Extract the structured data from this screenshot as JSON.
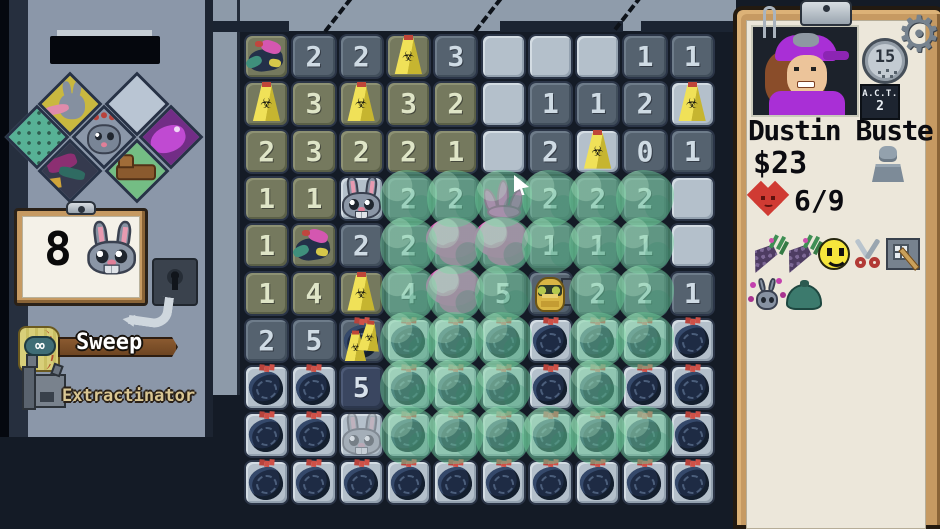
{
  "left_panel": {
    "badges": [
      {
        "id": "badge-yellow-rabbit"
      },
      {
        "id": "badge-empty"
      },
      {
        "id": "badge-teal-pattern"
      },
      {
        "id": "badge-rabbit-face"
      },
      {
        "id": "badge-purple-creature"
      },
      {
        "id": "badge-dark-creature"
      },
      {
        "id": "badge-green-couch"
      }
    ],
    "counter": {
      "value": "8",
      "icon": "rabbit-icon"
    },
    "tools": [
      {
        "id": "sweep",
        "label": "Sweep",
        "badge": "∞",
        "icon": "broom-icon"
      },
      {
        "id": "extractinator",
        "label": "Extractinator",
        "icon": "machine-icon"
      }
    ]
  },
  "character_panel": {
    "name": "Dustin Buste",
    "money": "$23",
    "health": "6/9",
    "timer": "15",
    "act_label": "A.C.T.",
    "act_value": "2",
    "inventory_row1": [
      "carrot",
      "carrot",
      "smiley-face",
      "scissors",
      "window-brush"
    ],
    "inventory_row2": [
      "flower-rabbit",
      "green-bag"
    ]
  },
  "grid": {
    "cols": 10,
    "rows": 10,
    "tile_legend": {
      "L": "unrevealed-light",
      "D": "revealed-dark",
      "O": "revealed-olive",
      "N": "revealed-darkest"
    },
    "sprite_legend": {
      "sign": "hazard-sign",
      "bag": "trash-bag",
      "trash": "junk-pile",
      "rabbit": "rabbit",
      "ghostrabbit": "faded-rabbit",
      "goldrabbit": "golden-rabbit",
      "pink": "pink-tentacle",
      "pinkblob": "pink-mass",
      "sign2bag": "two-signs-on-bag"
    },
    "cells": [
      [
        "O||trash|0",
        "D|2||0",
        "D|2||0",
        "O||sign|0",
        "D|3||0",
        "L|||0",
        "L|||0",
        "L|||0",
        "D|1||0",
        "D|1||0"
      ],
      [
        "O||sign|0",
        "O|3||0",
        "O||sign|0",
        "O|3||0",
        "O|2||0",
        "L|||0",
        "D|1||0",
        "D|1||0",
        "D|2||0",
        "L||sign|0"
      ],
      [
        "O|2||0",
        "O|3||0",
        "O|2||0",
        "O|2||0",
        "O|1||0",
        "L|||0",
        "D|2||0",
        "L||sign|0",
        "D|0||0",
        "D|1||0"
      ],
      [
        "O|1||0",
        "O|1||0",
        "L||rabbit|0",
        "D|2||1",
        "D|2||1",
        "D||pink|1",
        "D|2||1",
        "D|2||1",
        "D|2||1",
        "L|||0"
      ],
      [
        "O|1||0",
        "O||trash|0",
        "D|2||0",
        "D|2||1",
        "D||pinkblob|1",
        "D||pinkblob|1",
        "D|1||1",
        "D|1||1",
        "D|1||1",
        "L|||0"
      ],
      [
        "O|1||0",
        "O|4||0",
        "O||sign|0",
        "D|4||1",
        "D||pinkblob|1",
        "D|5||1",
        "D||goldrabbit|0",
        "D|2||1",
        "D|2||1",
        "D|1||0"
      ],
      [
        "D|2||0",
        "D|5||0",
        "D||sign2bag|0",
        "L||bag|1",
        "L||bag|1",
        "L||bag|1",
        "L||bag|0",
        "L||bag|1",
        "L||bag|1",
        "L||bag|0"
      ],
      [
        "L||bag|0",
        "L||bag|0",
        "N|5||0",
        "L||bag|1",
        "L||bag|1",
        "L||bag|1",
        "L||bag|0",
        "L||bag|1",
        "L||bag|0",
        "L||bag|0"
      ],
      [
        "L||bag|0",
        "L||bag|0",
        "L||ghostrabbit|0",
        "L||bag|1",
        "L||bag|1",
        "L||bag|1",
        "L||bag|1",
        "L||bag|1",
        "L||bag|1",
        "L||bag|0"
      ],
      [
        "L||bag|0",
        "L||bag|0",
        "L||bag|0",
        "L||bag|0",
        "L||bag|0",
        "L||bag|0",
        "L||bag|0",
        "L||bag|0",
        "L||bag|0",
        "L||bag|0"
      ]
    ]
  },
  "colors": {
    "sludge": "#6fc796",
    "sign_yellow": "#e8d84b",
    "bag_navy": "#1f2c42",
    "tile_light": "#b4c0cb",
    "tile_dark": "#55626f",
    "tile_olive": "#75795e",
    "tile_darkest": "#3a4660",
    "pink": "#df54bb",
    "wood_tan": "#c69a62",
    "paper_cream": "#ece7da",
    "heart_red": "#d03b33",
    "wall_gray": "#8f9cab",
    "background_navy": "#141b26"
  }
}
